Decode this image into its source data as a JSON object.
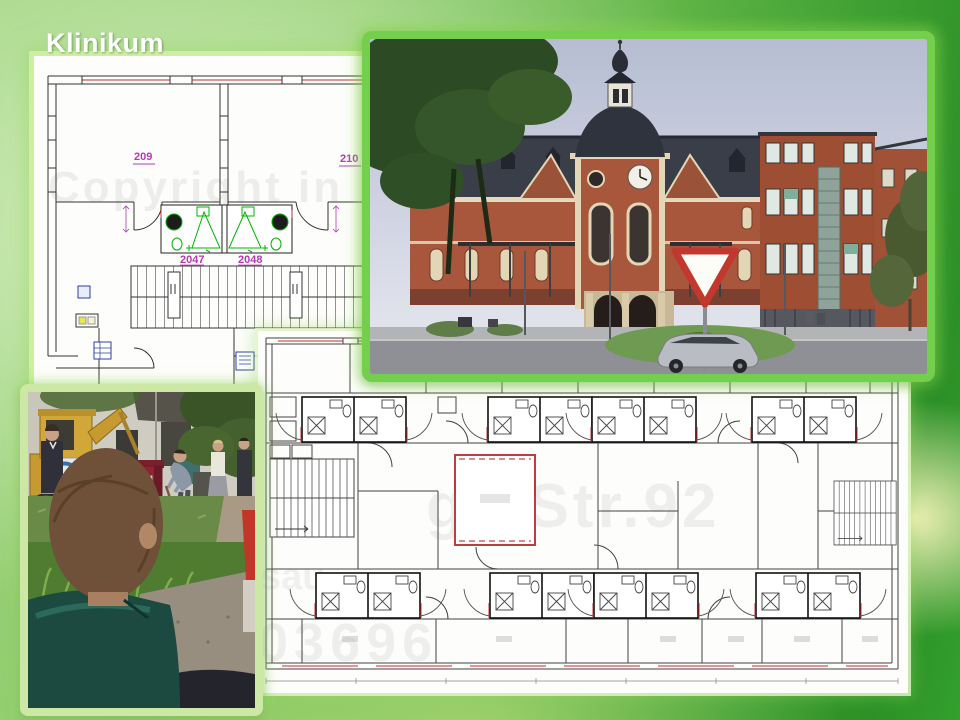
{
  "slide": {
    "title": "Klinikum"
  },
  "colors": {
    "photo_frame_green": "#74cf4c",
    "plan_label_magenta": "#b53ab5",
    "plan_highlight_green": "#00b400",
    "plan_window_red": "#c03030",
    "plan_furniture_blue": "#2d3fa0",
    "watermark_gray": "#8a8a8a"
  },
  "upper_plan": {
    "room_labels": [
      "209",
      "210"
    ],
    "bath_labels": [
      "2047",
      "2048"
    ],
    "watermark": "Copyright in"
  },
  "lower_plan": {
    "watermarks": [
      "ge Str.92",
      "sau",
      "03696"
    ]
  },
  "photos": {
    "building": "Historic clinic building with clock tower and modern wing",
    "groundbreaking": "Groundbreaking ceremony with excavator, red podium and spectators"
  }
}
